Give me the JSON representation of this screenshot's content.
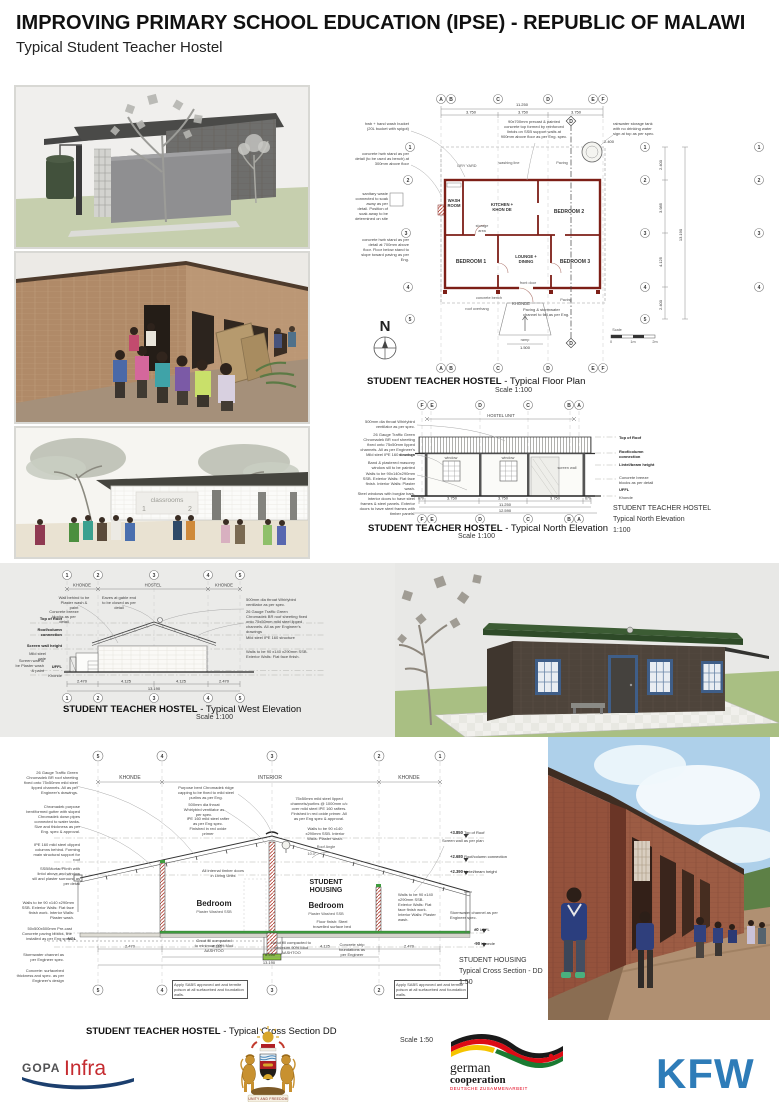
{
  "colors": {
    "wall_red": "#7d1f17",
    "roof_green": "#33512c",
    "floor_green": "#3f9b3f",
    "kfw_blue": "#2e7cb8",
    "gopa_red": "#c52b30",
    "gopa_navy": "#1c3f6e",
    "german_red": "#e2001a",
    "flag_gold": "#f5c400",
    "flag_green": "#1b7a32"
  },
  "header": {
    "title": "IMPROVING PRIMARY SCHOOL EDUCATION (IPSE) - REPUBLIC OF MALAWI",
    "subtitle": "Typical Student Teacher Hostel"
  },
  "plan": {
    "title": "STUDENT TEACHER HOSTEL",
    "suffix": "- Typical Floor Plan",
    "scale": "Scale 1:100",
    "letters": [
      "A",
      "B",
      "C",
      "D",
      "E",
      "F"
    ],
    "numbers": [
      "1",
      "2",
      "3",
      "4",
      "5"
    ],
    "marker": "D",
    "north": "N",
    "dim_total": "11.250",
    "dim_bay": "3.750",
    "dim_ramp": "1.500",
    "dim_tank": "2.400",
    "right_dims": [
      "2.400",
      "3.985",
      "4.125",
      "2.400"
    ],
    "right_total": "13.190",
    "rooms": {
      "wash1": "WASH",
      "wash2": "ROOM",
      "kitchen1": "KITCHEN +",
      "kitchen2": "KHON DE",
      "storage1": "storage",
      "storage2": "area",
      "bed2": "BEDROOM 2",
      "bed1": "BEDROOM 1",
      "lounge1": "LOUNGE +",
      "lounge2": "DINING",
      "bed3": "BEDROOM 3"
    },
    "labels": {
      "dry_yard": "DRY YARD",
      "washing_line": "washing line",
      "paving": "Paving",
      "khonde": "KHONDE",
      "concrete_bench": "concrete bench",
      "front_door": "front door",
      "roof_overhang": "roof overhang",
      "ramp": "ramp",
      "scale_word": "Scale",
      "s0": "0",
      "s1": "1m",
      "s2": "2m"
    },
    "notes": {
      "hwb": "hwb + hand wash bucket (20L bucket with spigot)",
      "stand300": "concrete hwb stand as per detail (to be used as bench) at 300mm above floor",
      "soak": "sanitary waste connected to soak away as per detail. Position of soak away to be determined on site",
      "stand700": "concrete hwb stand as per detail at 700mm above floor. Floor below stand to slope toward paving as per Eng.",
      "lintol": "90x700mm precast & painted concrete top formed by reinforced lintols on SSB support walls at 900mm above floor as per Eng. spec.",
      "tank": "rainwater storage tank with no drinking water sign at top as per spec.",
      "paving_channel": "Paving & stormwater channel to fall as per Eng."
    }
  },
  "nelev": {
    "title": "STUDENT TEACHER HOSTEL",
    "suffix": "- Typical North Elevation",
    "scale": "Scale 1:100",
    "letters": [
      "F",
      "E",
      "D",
      "C",
      "B",
      "A"
    ],
    "span": "HOSTEL UNIT",
    "window": "window",
    "screen_wall": "screen wall",
    "right": [
      "Top of Roof",
      "Roof/column connection",
      "Lintel/beam height",
      "Concrete breeze blocks as per detail",
      "UFFL",
      "Khonde"
    ],
    "notes": [
      "500mm dia throat Whirlybird ventilator as per spec.",
      "26 Gauge Traffic Green Chromadek BR roof sheeting fixed onto 75x50mm lipped channels. All as per Engineer's drawings",
      "Mild steel IPE 160 structure",
      "Band & plastered masonry window sill to be painted",
      "Walls to be 90x140x290mm SSB. Exterior Walls: Flat face finish. Interior Walls: Plaster wash.",
      "Steel windows with burglar bars. Interior doors to have steel frames & steel panels. Exterior doors to have steel frames with timber panels."
    ],
    "dims": [
      "670",
      "3.750",
      "3.750",
      "3.750",
      "670"
    ],
    "total1": "11.250",
    "total2": "12.590",
    "side": {
      "l1": "STUDENT TEACHER HOSTEL",
      "l2": "Typical North Elevation",
      "l3": "1:100"
    }
  },
  "welev": {
    "title": "STUDENT TEACHER HOSTEL",
    "suffix": "- Typical West Elevation",
    "scale": "Scale 1:100",
    "numbers": [
      "1",
      "2",
      "3",
      "4",
      "5"
    ],
    "spans": [
      "KHONDE",
      "HOSTEL",
      "KHONDE"
    ],
    "left": [
      "Top of Roof",
      "Roof/column connection",
      "Screen wall height",
      "UFFL",
      "Khonde"
    ],
    "notes_top": [
      "Wall behind to be Plaster wash & paint",
      "Eaves at gable end to be closed as per detail",
      "Concrete breeze blocks as per detail",
      "Mild steel gate",
      "Screen wall to be Plaster wash & paint"
    ],
    "notes_right": [
      "500mm dia throat Whirlybird ventilator as per spec.",
      "26 Gauge Traffic Green Chromadek BR roof sheeting fixed onto 75x50mm mild steel lipped channels. All as per Engineer's drawings",
      "Mild steel IPE 160 structure",
      "Walls to be 90 x140 x290mm SSB. Exterior Walls: Flat face finish."
    ],
    "dims": [
      "2.470",
      "4.125",
      "4.125",
      "2.470"
    ],
    "total": "13.190"
  },
  "xsec": {
    "title": "STUDENT TEACHER HOSTEL",
    "suffix": "- Typical Cross Section DD",
    "scale": "Scale 1:50",
    "numbers": [
      "5",
      "4",
      "3",
      "2",
      "1"
    ],
    "spans": [
      "KHONDE",
      "INTERIOR",
      "KHONDE"
    ],
    "housing1": "STUDENT",
    "housing2": "HOUSING",
    "bedroom": "Bedroom",
    "bedroom_sub": "Plaster Washed SSB",
    "angle_label": "Roof Angle",
    "angle": "10.0°",
    "ngl": "NGL",
    "levels": [
      [
        "+3.850",
        "Top of Roof"
      ],
      [
        "+2.680",
        "Roof/column connection"
      ],
      [
        "+2.390",
        "Lintel/beam height"
      ],
      [
        "±0",
        "UFFL"
      ],
      [
        "-90",
        "Khonde"
      ]
    ],
    "notes_left": [
      "26 Gauge Traffic Green Chromadek BR roof sheeting fixed onto 75x50mm mild steel lipped channels. All as per Engineer's drawings.",
      "Chromadek purpose bent/formed gutter with sloped Chromadek down pipes connected to water tanks. Size and thickness as per Eng. spec & approval.",
      "IPE 160 mild steel clipped columns behind. Forming main structural support for roof",
      "SSB/Mortar/Plinth with lintol above and window sill and plaster surround as per detail",
      "Walls to be 90 x140 x290mm SSB. Exterior Walls: Flat face finish work. Interior Walls: Plaster wash.",
      "50x500x500mm Pre-cast Concrete paving blocks, line installed as per Eng spec.",
      "Stormwater channel as per Engineer spec.",
      "Concrete: surfacebed thickness and spec. as per Engineer's design"
    ],
    "notes_mid": {
      "ridge": "Purpose bent Chromadek ridge capping to be fixed to mild steel purlins as per Eng.",
      "whirly": "500mm dia throat Whirlybird ventilator as per spec.",
      "rafter": "IPE 160 mild steel rafter as per Eng spec. Finished in red oxide primer",
      "purlins": "75x50mm mild steel lipped channels/purlins @ 1000mm c/c over mild steel IPE 160 rafters. Finished in red oxide primer. All as per Eng spec & approval.",
      "walls_int": "Walls to be 90 x140 x290mm SSB. Interior Walls: Plaster wash.",
      "doors": "All internal timber doors in Living Units",
      "screen": "Screen wall as per plan",
      "floor": "Floor finish: Steel trowelled surface bed",
      "grout": "Grout fill compacted to minimum 90% Mod AASHTOO",
      "strip": "Concrete strip foundations as per Engineer",
      "storm": "Stormwater channel as per Engineer spec."
    },
    "sabs": "Apply SABS approved ant and termite poison at all surfacebed and foundation walls.",
    "dims": [
      "2.470",
      "4.125",
      "4.125",
      "2.470"
    ],
    "dim_mid": "8.250",
    "total": "13.190",
    "side": {
      "l1": "STUDENT HOUSING",
      "l2": "Typical Cross Section - DD",
      "l3": "1:50"
    }
  },
  "classrooms": {
    "sign": "classrooms",
    "n1": "1",
    "n2": "2"
  },
  "logos": {
    "gopa": "GOPA",
    "infra": "Infra",
    "motto": "UNITY AND FREEDOM",
    "g1": "german",
    "g2": "cooperation",
    "g3": "DEUTSCHE ZUSAMMENARBEIT",
    "kfw": "KFW"
  }
}
